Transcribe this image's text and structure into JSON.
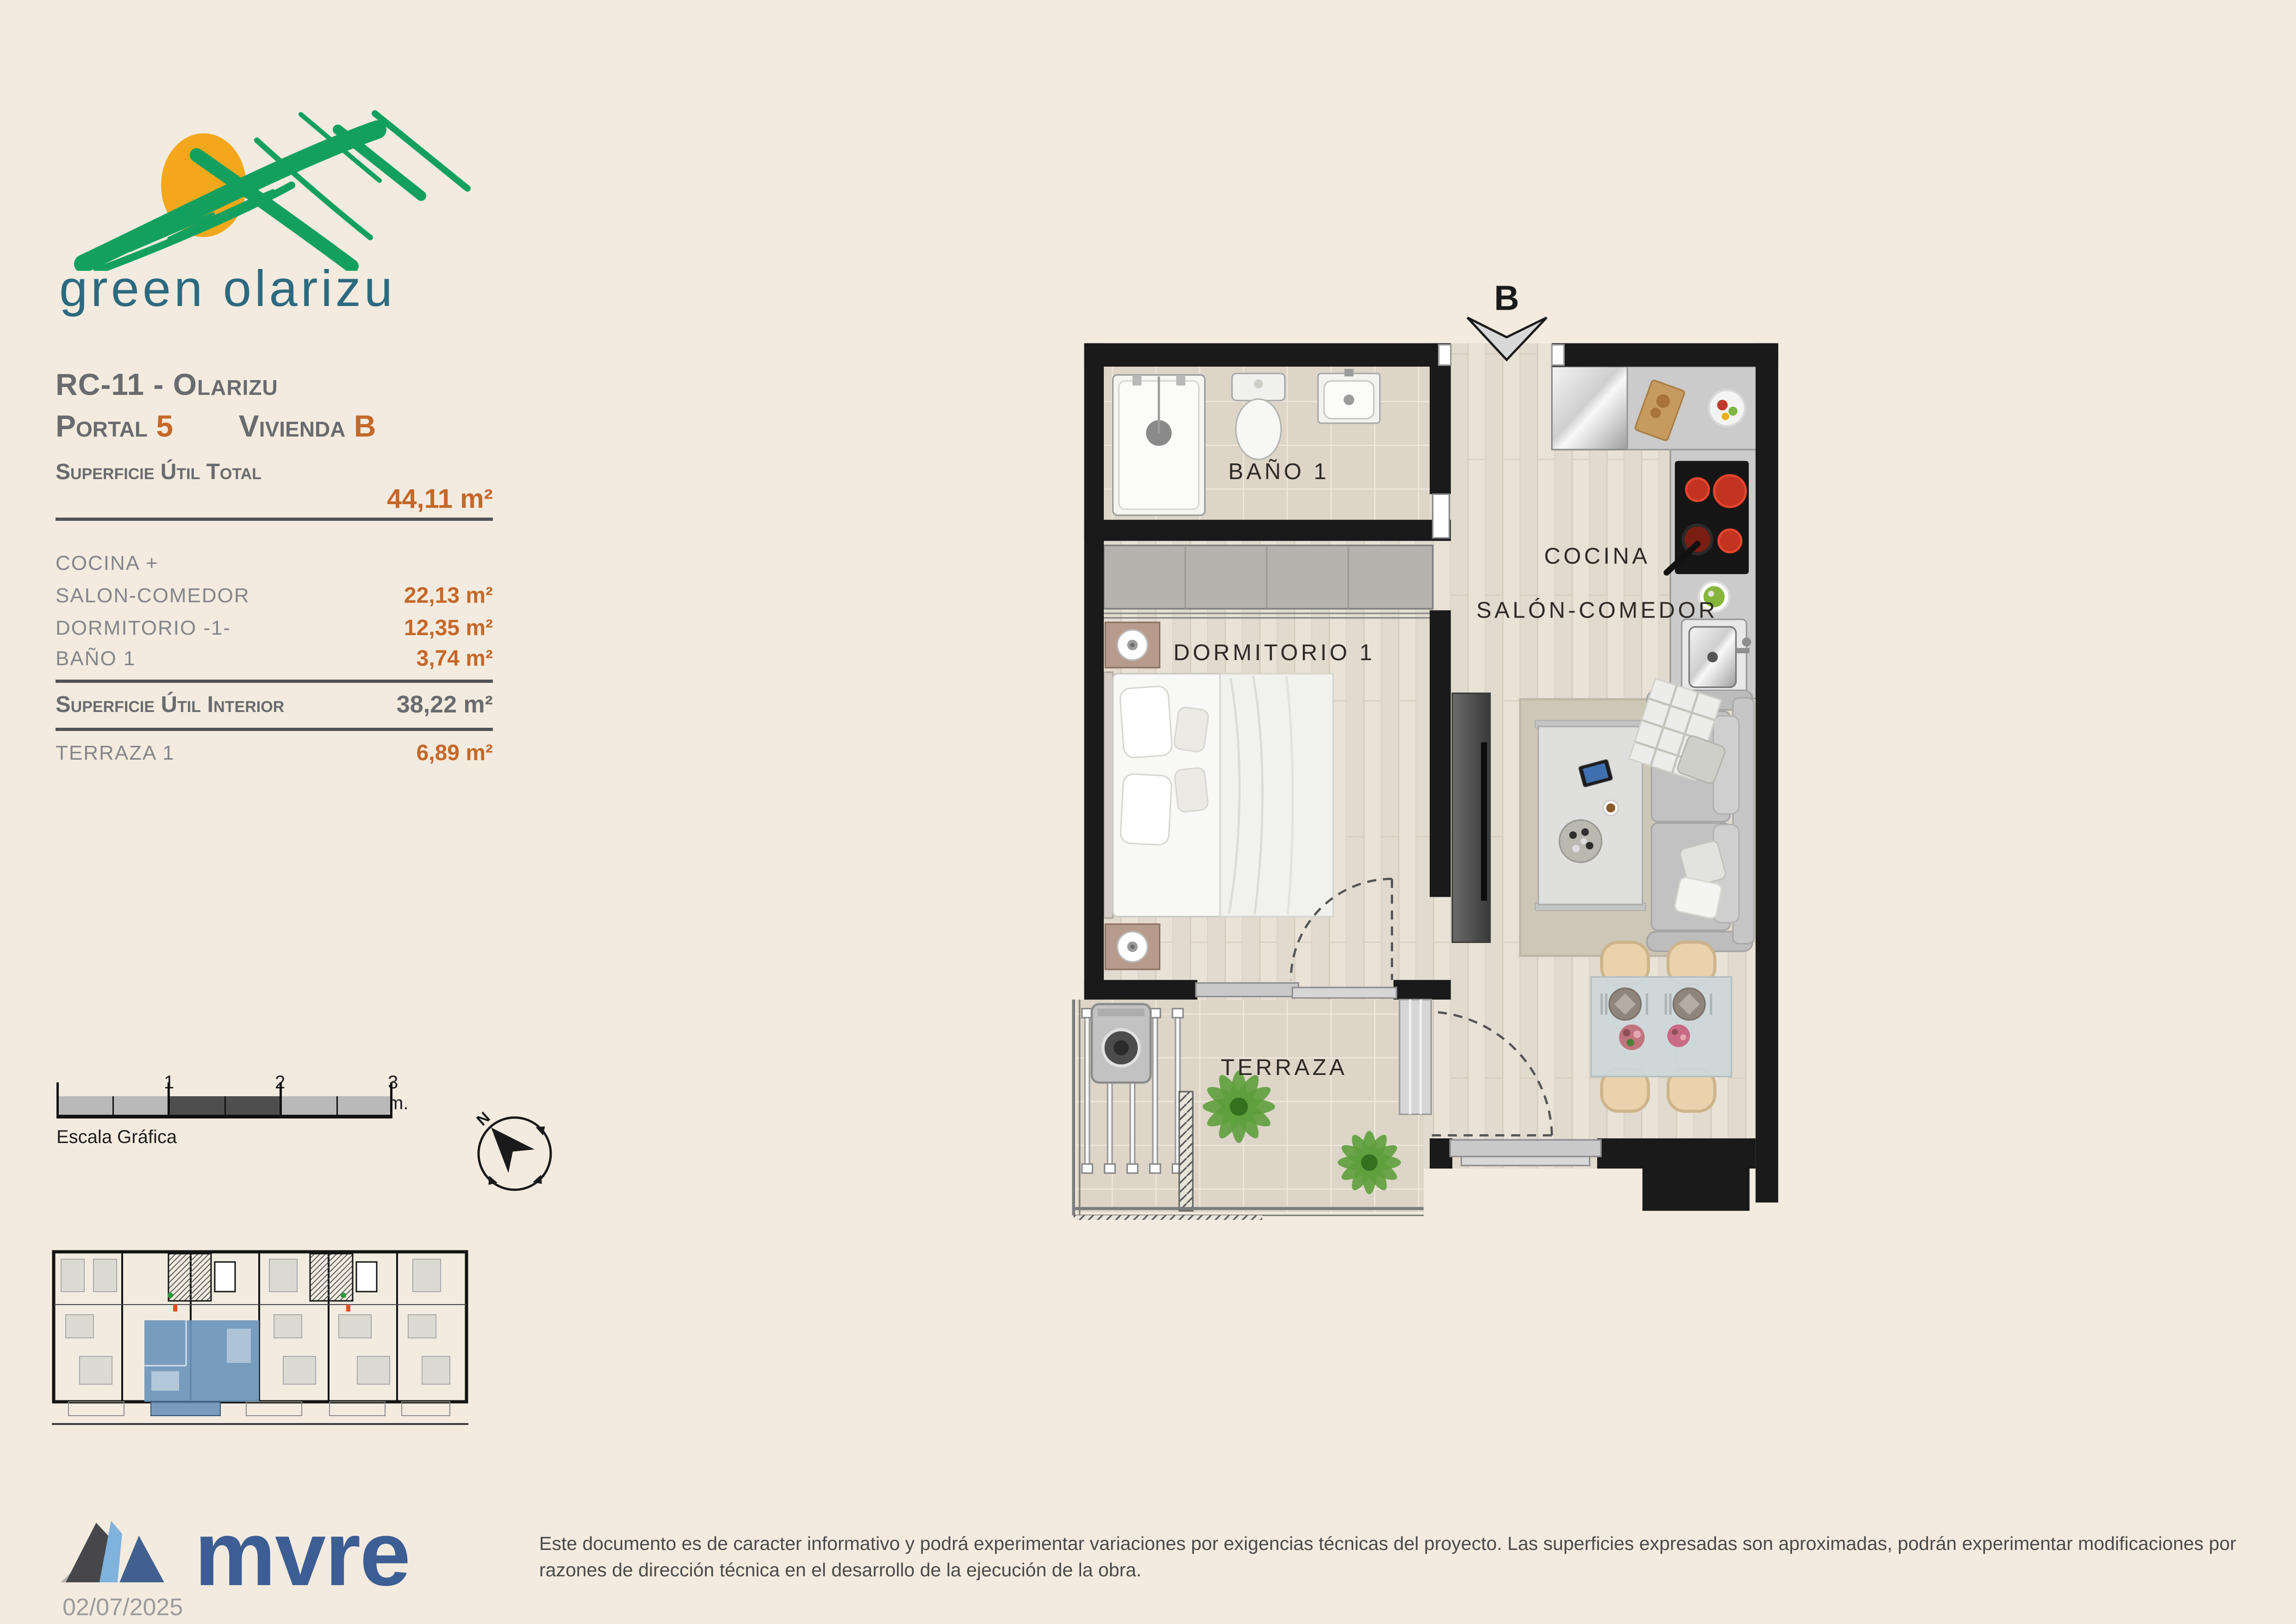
{
  "logo": {
    "text": "green olarizu"
  },
  "header": {
    "reference": "RC-11 - Olarizu",
    "portal_label": "Portal",
    "portal_value": "5",
    "unit_label": "Vivienda",
    "unit_value": "B"
  },
  "surface": {
    "total_label": "Superficie Útil Total",
    "total_value": "44,11 m²",
    "rows": [
      {
        "label": "COCINA +",
        "value": ""
      },
      {
        "label": "SALON-COMEDOR",
        "value": "22,13 m²"
      },
      {
        "label": "DORMITORIO -1-",
        "value": "12,35 m²"
      },
      {
        "label": "BAÑO 1",
        "value": "3,74 m²"
      }
    ],
    "interior_label": "Superficie Útil Interior",
    "interior_value": "38,22 m²",
    "terrace_label": "TERRAZA 1",
    "terrace_value": "6,89 m²"
  },
  "scalebar": {
    "tick1": "1",
    "tick2": "2",
    "tick3": "3 m.",
    "caption": "Escala Gráfica"
  },
  "compass": {
    "north": "N"
  },
  "floorplan": {
    "marker": "B",
    "rooms": {
      "bathroom": "BAÑO 1",
      "kitchen": "COCINA",
      "living": "SALÓN-COMEDOR",
      "bedroom": "DORMITORIO 1",
      "terrace": "TERRAZA"
    }
  },
  "brand": {
    "name": "mvre",
    "date": "02/07/2025"
  },
  "footer": {
    "disclaimer": "Este documento es de caracter informativo y podrá experimentar variaciones por exigencias técnicas del proyecto. Las superficies expresadas son aproximadas, podrán experimentar modificaciones por razones de dirección técnica en el desarrollo de la ejecución de la obra."
  },
  "colors": {
    "background": "#f3ebdf",
    "accent_orange": "#c4682a",
    "heading_gray": "#6a6b6e",
    "logo_teal": "#2c6a80",
    "logo_green": "#13a05f",
    "logo_sun": "#f3a81c",
    "brand_blue": "#3d5e94",
    "highlight_blue": "#6d95ba",
    "wall_black": "#1a1a1a"
  }
}
